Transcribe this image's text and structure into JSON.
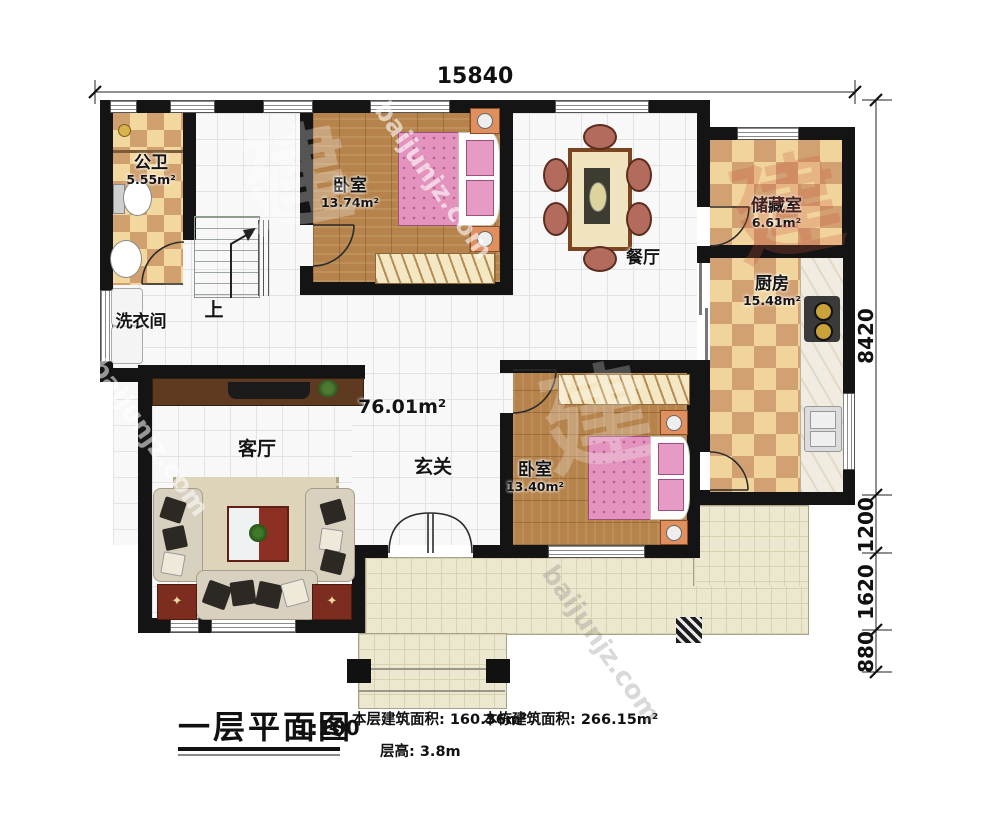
{
  "dimensions": {
    "top_width": "15840",
    "right": [
      {
        "label": "8420"
      },
      {
        "label": "1200"
      },
      {
        "label": "1620"
      },
      {
        "label": "880"
      }
    ]
  },
  "rooms": {
    "bathroom": {
      "name": "公卫",
      "area": "5.55m²"
    },
    "bedroom1": {
      "name": "卧室",
      "area": "13.74m²"
    },
    "dining": {
      "name": "餐厅"
    },
    "storage": {
      "name": "储藏室",
      "area": "6.61m²"
    },
    "kitchen": {
      "name": "厨房",
      "area": "15.48m²"
    },
    "laundry": {
      "name": "洗衣间"
    },
    "living": {
      "name": "客厅"
    },
    "foyer": {
      "name": "玄关"
    },
    "bedroom2": {
      "name": "卧室",
      "area": "13.40m²"
    },
    "open_area_label": "76.01m²",
    "stairs_up_label": "上"
  },
  "title_block": {
    "title": "一层平面图",
    "scale": "1:100",
    "floor_area": "本层建筑面积: 160.36m²",
    "building_area": "本栋建筑面积: 266.15m²",
    "floor_height": "层高: 3.8m"
  },
  "watermark": {
    "domain": "baijunjz.com",
    "domain_long": "u.baijunjz.com",
    "glyph": "建"
  },
  "colors": {
    "wall": "#141414",
    "wood_floor": "#b5834b",
    "checker_light": "#f0d49c",
    "checker_dark": "#d2a173",
    "terrace": "#ece7cf",
    "bed_pink": "#e393bd"
  }
}
